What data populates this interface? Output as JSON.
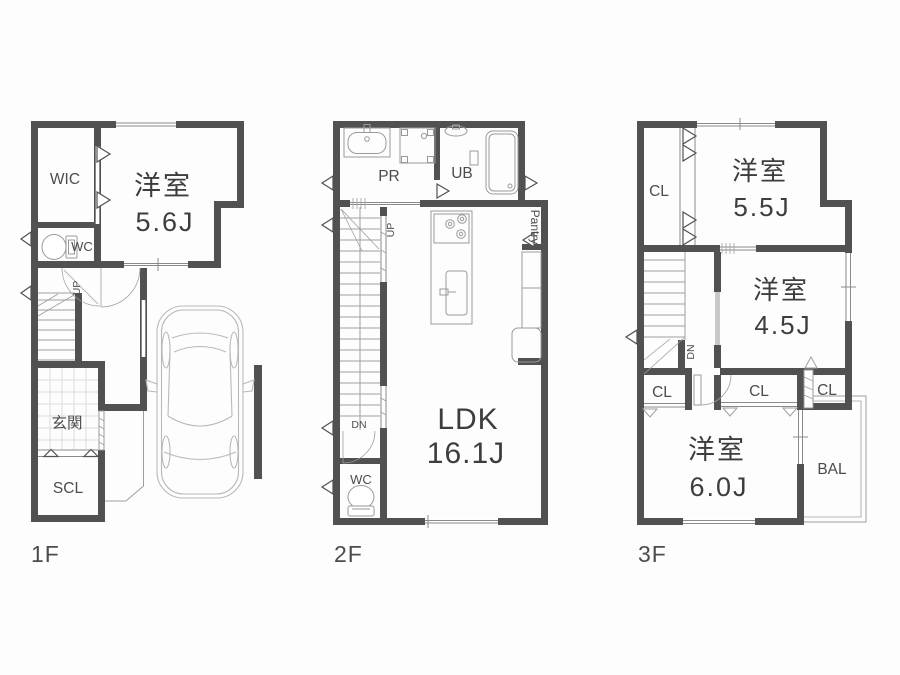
{
  "palette": {
    "wall": "#515151",
    "line": "#9e9e9e",
    "window_line": "#8a8a8a",
    "fixture": "#9a9a9a",
    "grid": "#dcdcdc",
    "car": "#b9b9b9",
    "text_primary": "#3d3d3d",
    "text_secondary": "#4c4c4c",
    "background": "#fdfdfd"
  },
  "floors": [
    {
      "name": "1F",
      "rooms": {
        "wic": "WIC",
        "bedroom": "洋室",
        "bedroom_size": "5.6J",
        "wc": "WC",
        "entrance": "玄関",
        "shoe_closet": "SCL"
      },
      "stairs": {
        "up": "UP"
      }
    },
    {
      "name": "2F",
      "rooms": {
        "powder_room": "PR",
        "unit_bath": "UB",
        "pantry": "Pantry",
        "ldk": "LDK",
        "ldk_size": "16.1J",
        "wc": "WC"
      },
      "stairs": {
        "up": "UP",
        "down": "DN"
      }
    },
    {
      "name": "3F",
      "rooms": {
        "closet_a": "CL",
        "bedroom_a": "洋室",
        "bedroom_a_size": "5.5J",
        "bedroom_b": "洋室",
        "bedroom_b_size": "4.5J",
        "closet_b": "CL",
        "closet_c": "CL",
        "closet_d": "CL",
        "bedroom_c": "洋室",
        "bedroom_c_size": "6.0J",
        "balcony": "BAL"
      },
      "stairs": {
        "down": "DN"
      }
    }
  ]
}
